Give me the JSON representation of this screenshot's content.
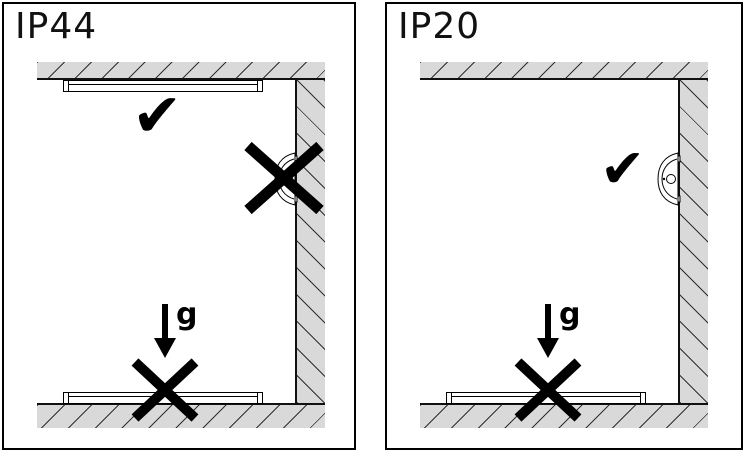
{
  "panels": [
    {
      "label": "IP44",
      "gravity_label": "g",
      "mounting": {
        "ceiling": "allowed",
        "wall": "not-allowed",
        "floor": "not-allowed"
      }
    },
    {
      "label": "IP20",
      "gravity_label": "g",
      "mounting": {
        "wall": "allowed",
        "floor": "not-allowed"
      }
    }
  ],
  "glyphs": {
    "check": "✔"
  },
  "colors": {
    "surface": "#d9d9d9",
    "hatch": "#2e2e2e",
    "line": "#000000",
    "background": "#ffffff"
  }
}
